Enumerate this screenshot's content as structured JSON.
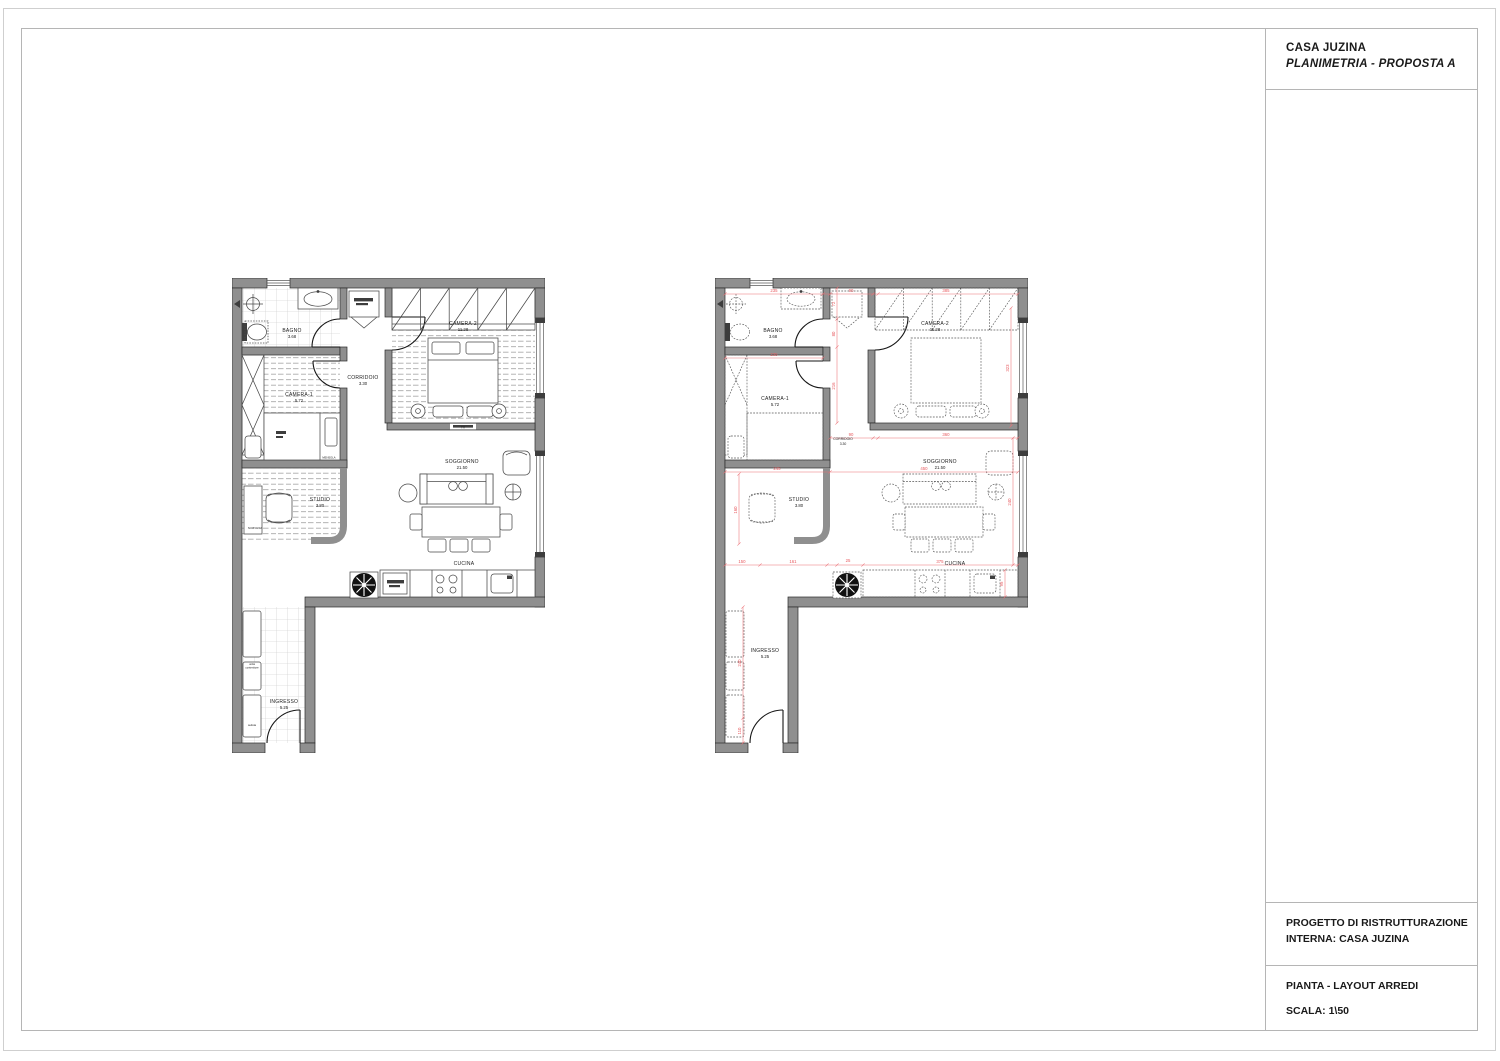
{
  "title_block": {
    "project_title": "CASA JUZINA",
    "subtitle": "PLANIMETRIA - PROPOSTA  A",
    "section_project_line1": "PROGETTO DI RISTRUTTURAZIONE",
    "section_project_line2": "INTERNA: CASA JUZINA",
    "section_sheet_line1": "PIANTA - LAYOUT ARREDI",
    "section_sheet_line2": "SCALA: 1\\50"
  },
  "colors": {
    "wall": "#8f8f8f",
    "dimension_red": "#e85b60"
  },
  "plans": {
    "left": {
      "rooms": {
        "bagno": {
          "label": "BAGNO",
          "area": "3.68"
        },
        "camera1": {
          "label": "CAMERA-1",
          "area": "5.72"
        },
        "camera2": {
          "label": "CAMERA-2",
          "area": "11.28"
        },
        "corridoio": {
          "label": "CORRIDOIO",
          "area": "3.30"
        },
        "soggiorno": {
          "label": "SOGGIORNO",
          "area": "21.50"
        },
        "studio": {
          "label": "STUDIO",
          "area": "3.80"
        },
        "cucina": {
          "label": "CUCINA"
        },
        "ingresso": {
          "label": "INGRESSO",
          "area": "5.25"
        }
      },
      "notes": {
        "mensola": "MENSOLA",
        "scrivania": "SCRIVANIA",
        "tv": "TV",
        "container_line1": "unità",
        "container_line2": "contenitore",
        "seat": "seduta"
      }
    },
    "right": {
      "rooms": {
        "bagno": {
          "label": "BAGNO",
          "area": "3.68"
        },
        "camera1": {
          "label": "CAMERA-1",
          "area": "5.72"
        },
        "camera2": {
          "label": "CAMERA-2",
          "area": "11.28"
        },
        "corridoio": {
          "label": "CORRIDOIO",
          "area": "3.30"
        },
        "soggiorno": {
          "label": "SOGGIORNO",
          "area": "21.50"
        },
        "studio": {
          "label": "STUDIO",
          "area": "3.80"
        },
        "cucina": {
          "label": "CUCINA"
        },
        "ingresso": {
          "label": "INGRESSO",
          "area": "5.25"
        }
      },
      "dimensions": [
        "235",
        "90",
        "385",
        "235",
        "72",
        "80",
        "216",
        "323",
        "90",
        "360",
        "245",
        "450",
        "160",
        "150",
        "161",
        "25",
        "375",
        "240",
        "95",
        "240",
        "110"
      ]
    }
  }
}
